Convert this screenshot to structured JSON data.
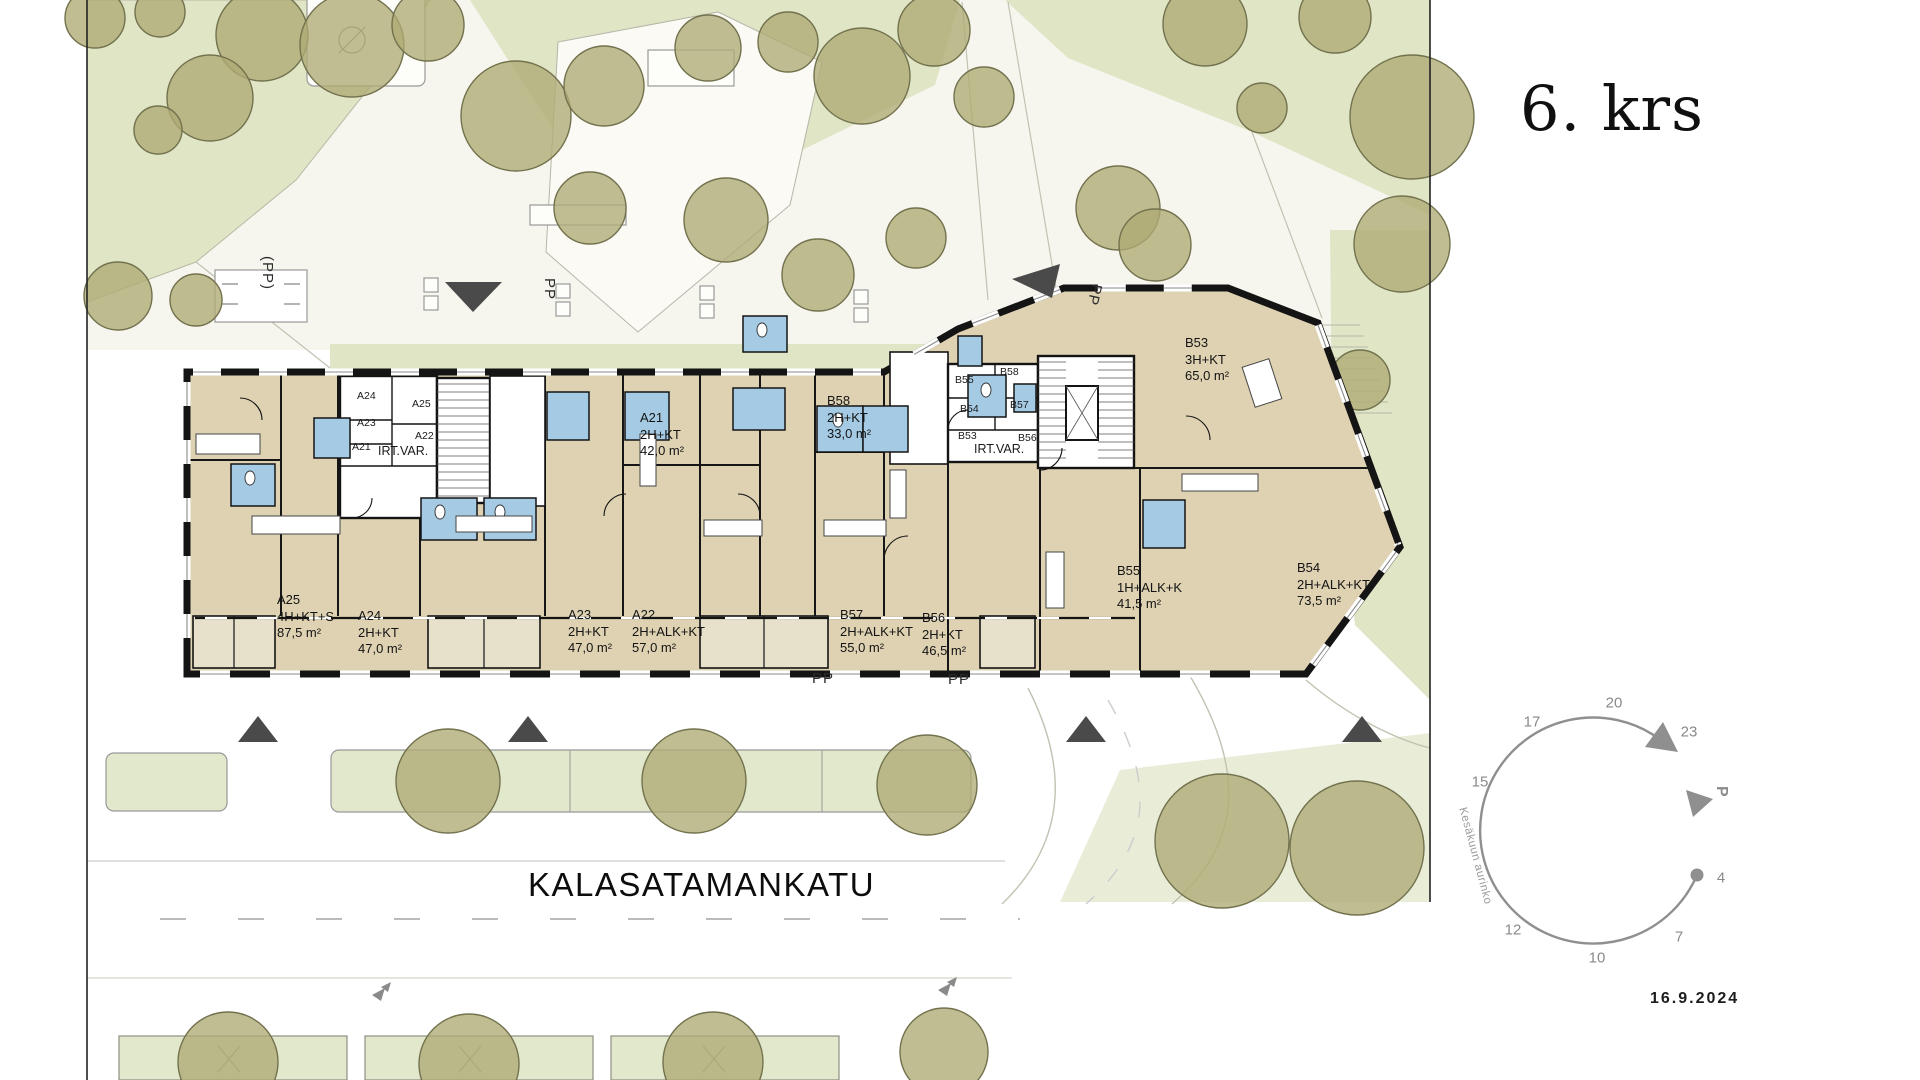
{
  "panel": {
    "floor_title": "6. krs",
    "date": "16.9.2024"
  },
  "street": {
    "name": "KALASATAMANKATU"
  },
  "markers": {
    "pp": "PP",
    "pp_paren": "(PP)"
  },
  "building": {
    "apartments": [
      {
        "id": "A25",
        "type": "4H+KT+S",
        "area": "87,5 m²"
      },
      {
        "id": "A24",
        "type": "2H+KT",
        "area": "47,0 m²"
      },
      {
        "id": "A23",
        "type": "2H+KT",
        "area": "47,0 m²"
      },
      {
        "id": "A22",
        "type": "2H+ALK+KT",
        "area": "57,0 m²"
      },
      {
        "id": "A21",
        "type": "2H+KT",
        "area": "42,0 m²"
      },
      {
        "id": "B58",
        "type": "2H+KT",
        "area": "33,0 m²"
      },
      {
        "id": "B57",
        "type": "2H+ALK+KT",
        "area": "55,0 m²"
      },
      {
        "id": "B56",
        "type": "2H+KT",
        "area": "46,5 m²"
      },
      {
        "id": "B55",
        "type": "1H+ALK+K",
        "area": "41,5 m²"
      },
      {
        "id": "B54",
        "type": "2H+ALK+KT",
        "area": "73,5 m²"
      },
      {
        "id": "B53",
        "type": "3H+KT",
        "area": "65,0 m²"
      }
    ],
    "storage_label": "IRT.VAR.",
    "storage_left": [
      "A24",
      "A25",
      "A23",
      "A22",
      "A21"
    ],
    "storage_right": [
      "B55",
      "B58",
      "B54",
      "B57",
      "B53",
      "B56"
    ]
  },
  "sun_diagram": {
    "caption": "Kesäkuun aurinko",
    "north_label": "P",
    "hours": [
      "23",
      "20",
      "17",
      "15",
      "12",
      "10",
      "7",
      "4"
    ]
  },
  "colors": {
    "tree": "#aeab74",
    "green_area": "#dfe5c5",
    "floor": "#ded2b2",
    "balcony": "#e7e0ca",
    "wet_room": "#a5cbe4",
    "wall": "#141414",
    "diagram_gray": "#8f8f8f"
  }
}
